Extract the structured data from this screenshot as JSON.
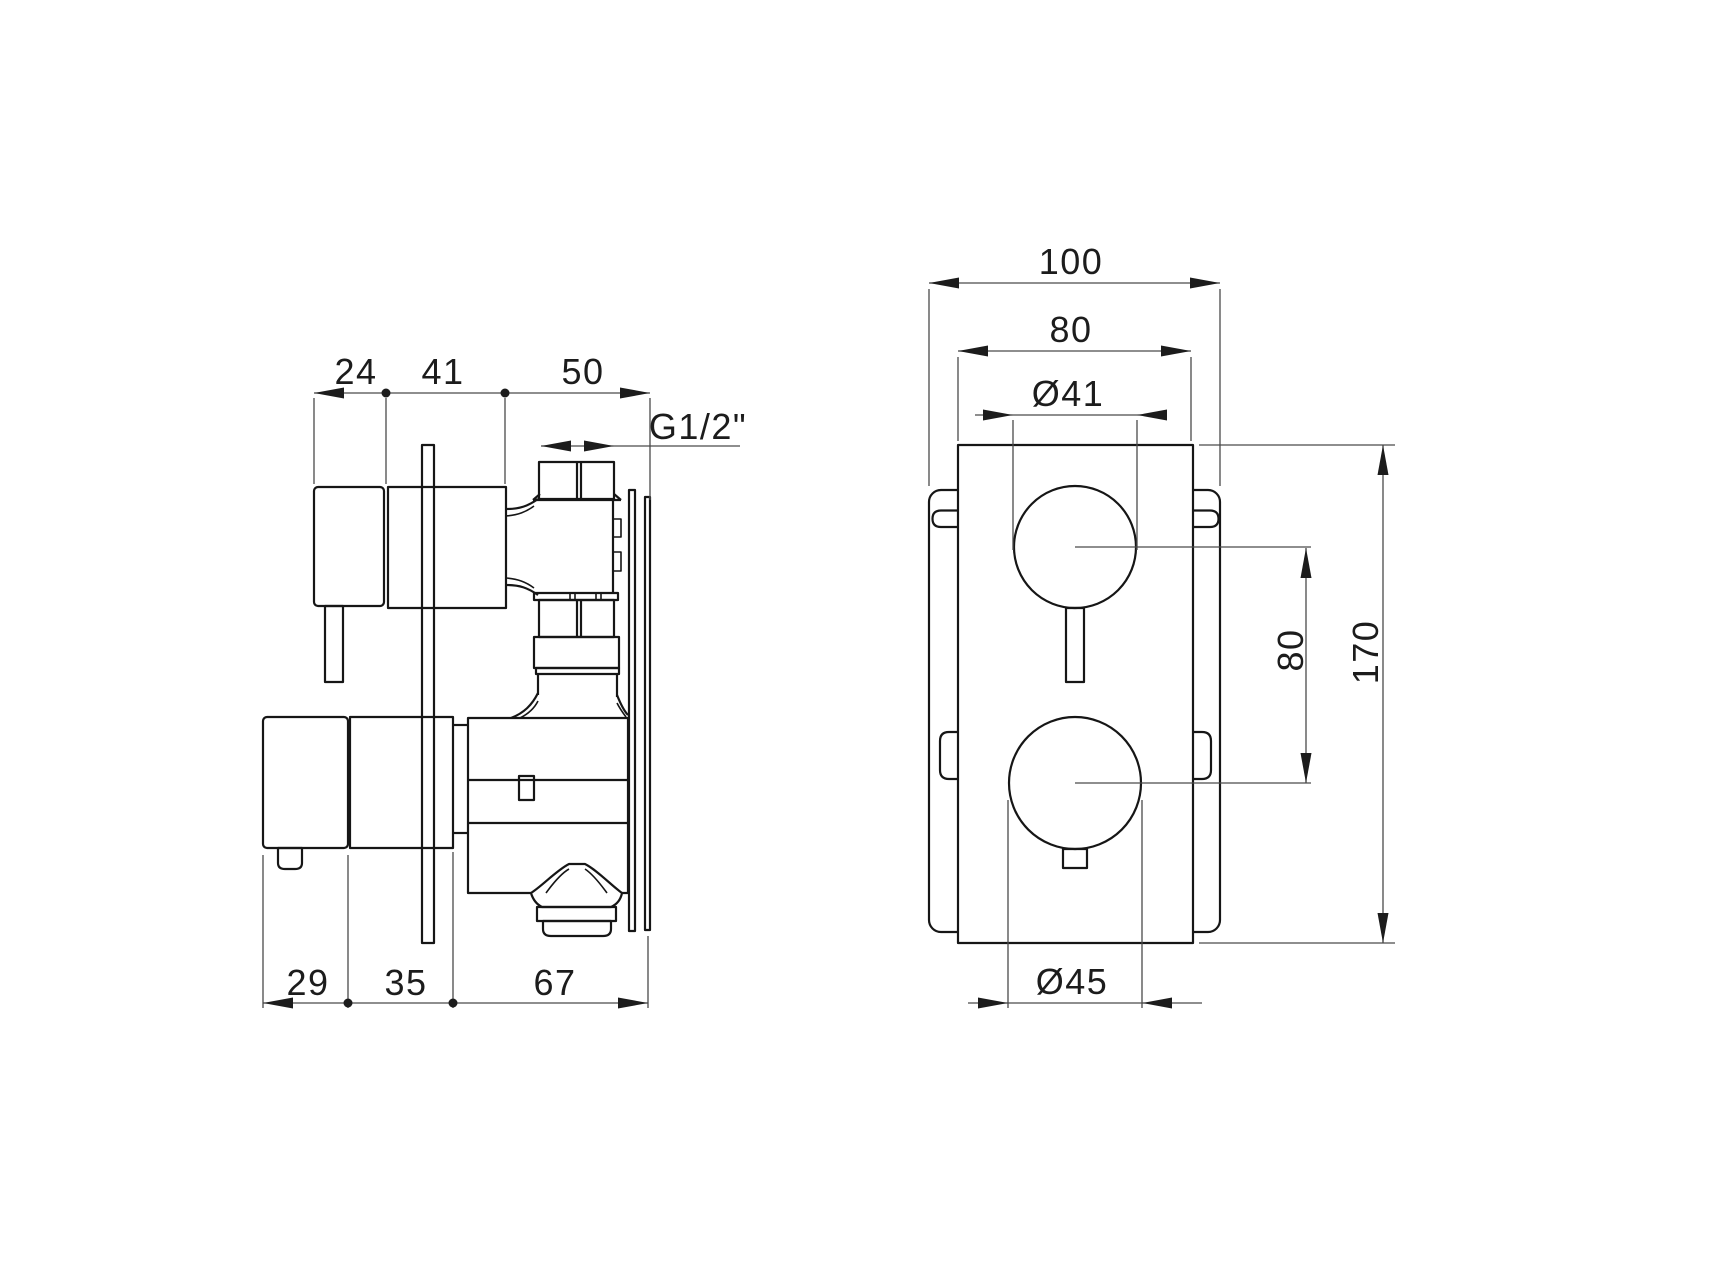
{
  "colors": {
    "line": "#161616",
    "dim_line": "#4a4a4a",
    "background": "#ffffff"
  },
  "side_view": {
    "top_dims": {
      "d24": "24",
      "d41": "41",
      "d50": "50"
    },
    "thread": "G1/2\"",
    "bottom_dims": {
      "d29": "29",
      "d35": "35",
      "d67": "67"
    }
  },
  "front_view": {
    "width_overall": "100",
    "width_plate": "80",
    "dia_top": "Ø41",
    "spacing": "80",
    "height_plate": "170",
    "dia_bottom": "Ø45"
  }
}
